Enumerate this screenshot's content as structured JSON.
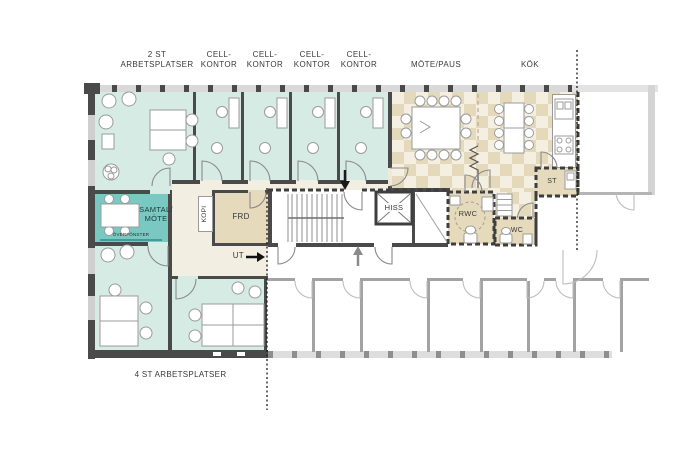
{
  "plan": {
    "colors": {
      "office_teal": "#d5ebe3",
      "meeting_teal": "#79c8c1",
      "corridor_cream": "#f2eee1",
      "storage_beige": "#e6dabc",
      "checker_tan": "#e5d9bc",
      "wall_dark": "#4a4a4a",
      "window_gray": "#d9d9d9",
      "boundary_black": "#1a1a1a"
    },
    "top_labels": [
      {
        "line1": "2 ST",
        "line2": "ARBETSPLATSER"
      },
      {
        "line1": "CELL-",
        "line2": "KONTOR"
      },
      {
        "line1": "CELL-",
        "line2": "KONTOR"
      },
      {
        "line1": "CELL-",
        "line2": "KONTOR"
      },
      {
        "line1": "CELL-",
        "line2": "KONTOR"
      },
      {
        "line1": "MÖTE/PAUS",
        "line2": ""
      },
      {
        "line1": "KÖK",
        "line2": ""
      }
    ],
    "room_labels": {
      "samtal_line1": "SAMTAL/",
      "samtal_line2": "MÖTE",
      "overfonster": "ÖVERFÖNSTER",
      "kopi": "KOPI",
      "frd": "FRD",
      "hiss": "HISS",
      "rwc": "RWC",
      "wc": "WC",
      "st": "ST",
      "ut": "UT"
    },
    "bottom_label": "4 ST ARBETSPLATSER"
  }
}
